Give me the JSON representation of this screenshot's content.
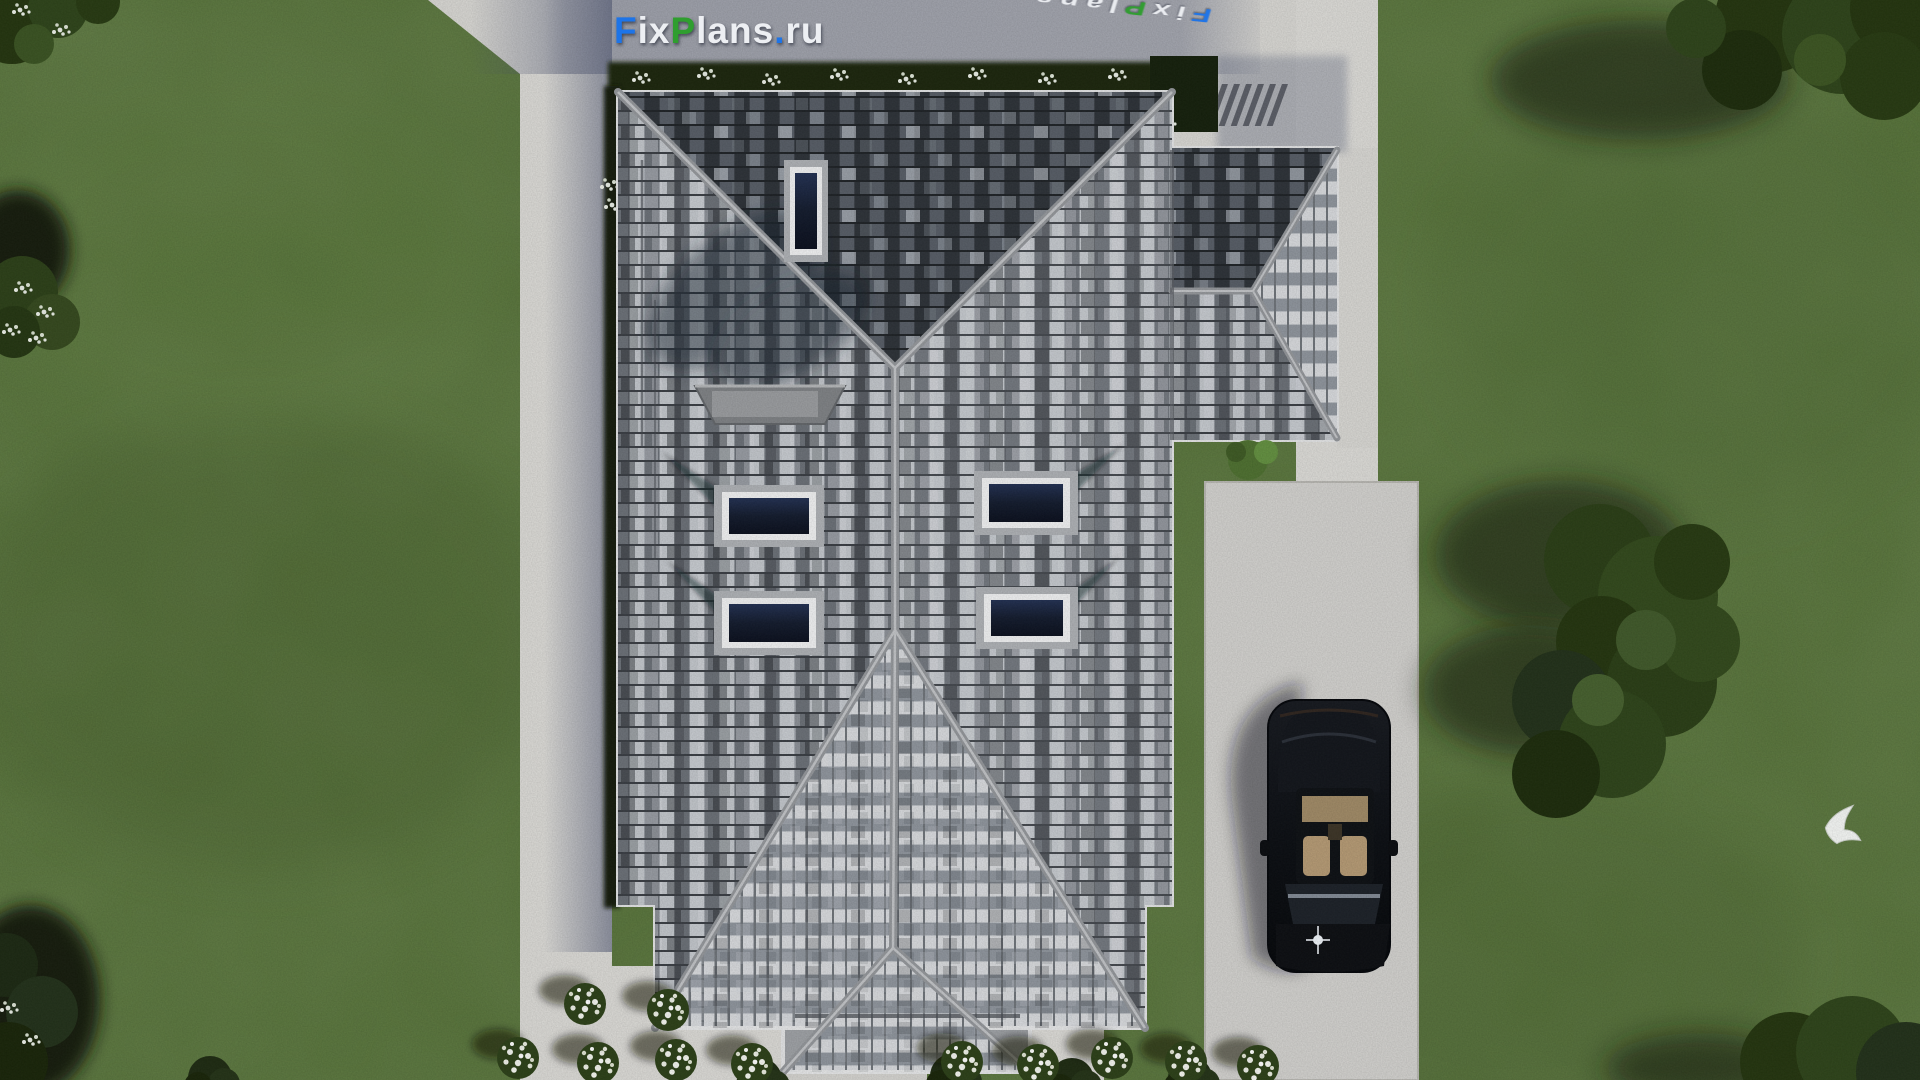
{
  "watermark": {
    "full_text": "FixPlans.ru",
    "segments": [
      {
        "text": "F",
        "color": "#1d74e8"
      },
      {
        "text": "ix",
        "color": "#edeff3"
      },
      {
        "text": "P",
        "color": "#2f9e2f"
      },
      {
        "text": "lans",
        "color": "#edeff3"
      },
      {
        "text": ".",
        "color": "#1d74e8"
      },
      {
        "text": "ru",
        "color": "#edeff3"
      }
    ]
  },
  "ground_watermark": {
    "full_text": "FixPlans.ru",
    "segments": [
      {
        "text": "F",
        "color": "#1d74e8"
      },
      {
        "text": "ix",
        "color": "#edeff3"
      },
      {
        "text": "P",
        "color": "#2f9e2f"
      },
      {
        "text": "lans",
        "color": "#edeff3"
      },
      {
        "text": ".",
        "color": "#1d74e8"
      },
      {
        "text": "ru",
        "color": "#edeff3"
      }
    ]
  },
  "colors": {
    "grass": "#567239",
    "grass_dark": "#42582c",
    "grass_light": "#6b8a4a",
    "pavement": "#d8d7d3",
    "driveway": "#d2d1ce",
    "roof_light": "#c7cad0",
    "roof_mid": "#8e939a",
    "roof_dark": "#3c4148",
    "ridge": "#9b9ea2",
    "eave_trim": "#e3e4e5",
    "hedge": "#1a250f",
    "foliage": "#2e421e",
    "skylight_glass": "#131b2d",
    "skylight_frame": "#f0f1f2",
    "car_body": "#0b0e13",
    "car_interior": "#b59a74",
    "shadow_blue": "#4a5270",
    "bird_white": "#f5f7f5",
    "logo_blue": "#1d74e8",
    "logo_green": "#2f9e2f",
    "logo_white": "#edeff3"
  }
}
